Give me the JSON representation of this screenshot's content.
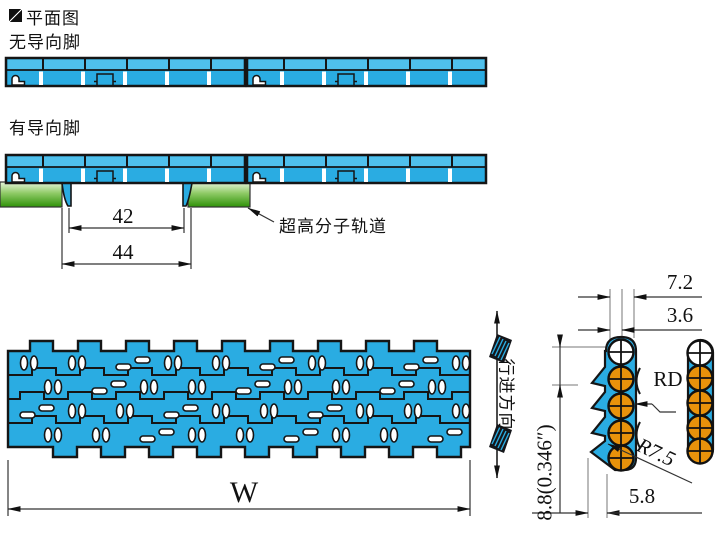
{
  "header": {
    "title": "平面图",
    "variant_no_guide": "无导向脚",
    "variant_with_guide": "有导向脚"
  },
  "side_view": {
    "dim_inner": "42",
    "dim_outer": "44",
    "track_label": "超高分子轨道"
  },
  "plan_view": {
    "dim_width": "W",
    "direction_label": "行进方向"
  },
  "section_view": {
    "dim_pitch": "7.2",
    "dim_half_pitch": "3.6",
    "rod_label": "RD",
    "radius_label": "R7.5",
    "dim_foot": "5.8",
    "dim_height": "8.8(0.346″)"
  },
  "colors": {
    "belt_blue": "#2AACE2",
    "belt_blue_light": "#4FC0EC",
    "outline": "#151515",
    "track_green_light": "#e8f6dc",
    "track_green_dark": "#2e9208",
    "rod_orange": "#E8920B"
  }
}
